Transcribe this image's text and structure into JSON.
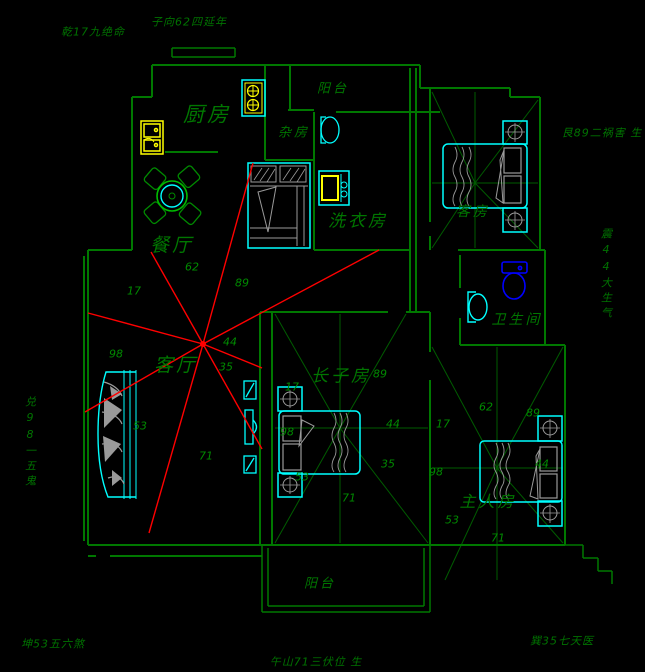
{
  "title": "Feng-shui apartment floor plan (CAD drawing)",
  "perimeter_labels": {
    "top_left": "乾17九绝命",
    "top_center": "子向62四延年",
    "right_top": "艮89二祸害 生",
    "right_middle_vertical": "震44大生气",
    "left_middle_vertical": "兑98一五鬼",
    "bottom_left": "坤53五六煞",
    "bottom_center": "午山71三伏位 生",
    "bottom_right": "巽35七天医"
  },
  "rooms": {
    "kitchen": "厨房",
    "balcony_top": "阳台",
    "storage": "杂房",
    "laundry": "洗衣房",
    "guest_room": "客房",
    "dining_room": "餐厅",
    "living_room": "客厅",
    "eldest_son_room": "长子房",
    "bathroom": "卫生间",
    "master_room": "主人房",
    "balcony_bottom": "阳台"
  },
  "numbers": {
    "living": [
      "62",
      "17",
      "89",
      "98",
      "44",
      "35",
      "53",
      "71"
    ],
    "son": [
      "89",
      "17",
      "44",
      "98",
      "35",
      "53",
      "71"
    ],
    "master": [
      "62",
      "17",
      "89",
      "98",
      "44",
      "53",
      "71"
    ]
  },
  "colors": {
    "wall_green": "#007800",
    "text_green": "#008000",
    "furniture_cyan": "#00ffff",
    "appliance_yellow": "#ffff00",
    "toilet_blue": "#0000ff",
    "star_red": "#ff0000",
    "detail_gray": "#9a9a9a",
    "background": "#000000"
  }
}
